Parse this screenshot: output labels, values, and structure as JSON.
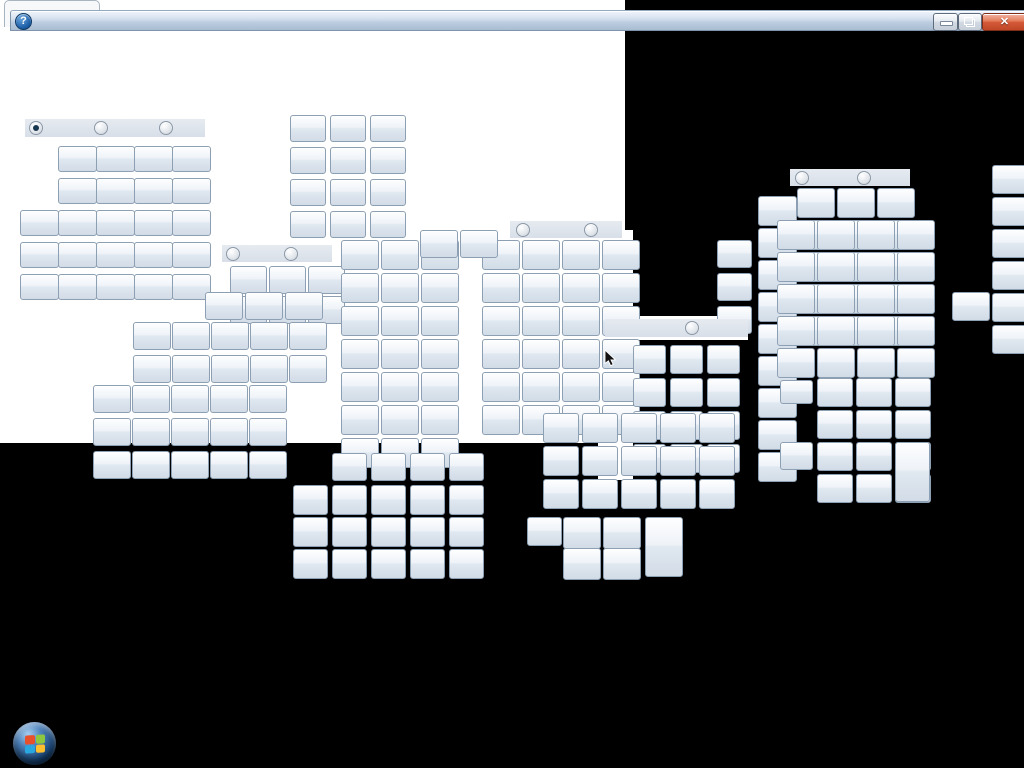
{
  "scene": {
    "desktop_bg": "#000000",
    "patch_color": "#ffffff",
    "white_patches": [
      {
        "x": 0,
        "y": 0,
        "w": 625,
        "h": 443
      },
      {
        "x": 598,
        "y": 230,
        "w": 35,
        "h": 250
      },
      {
        "x": 625,
        "y": 316,
        "w": 123,
        "h": 24
      }
    ]
  },
  "window": {
    "tab": {
      "x": 4,
      "y": 0,
      "w": 94,
      "h": 26
    },
    "titlebar": {
      "x": 10,
      "y": 10,
      "w": 1014,
      "h": 19
    },
    "help_icon_glyph": "?",
    "caption_buttons": [
      {
        "name": "minimize-button",
        "x": 922,
        "y": 2,
        "w": 23,
        "h": 16,
        "kind": "minimize"
      },
      {
        "name": "restore-button",
        "x": 947,
        "y": 2,
        "w": 22,
        "h": 16,
        "kind": "restore"
      },
      {
        "name": "close-button",
        "x": 971,
        "y": 2,
        "w": 43,
        "h": 16,
        "kind": "close",
        "glyph_char": "✕"
      }
    ]
  },
  "button_grids": [
    {
      "x": 58,
      "y": 146,
      "c": 4,
      "r": 2,
      "w": 37,
      "h": 24,
      "px": 38,
      "py": 32
    },
    {
      "x": 20,
      "y": 210,
      "c": 5,
      "r": 3,
      "w": 37,
      "h": 24,
      "px": 38,
      "py": 32
    },
    {
      "x": 290,
      "y": 115,
      "c": 3,
      "r": 4,
      "w": 34,
      "h": 25,
      "px": 40,
      "py": 32
    },
    {
      "x": 230,
      "y": 266,
      "c": 3,
      "r": 2,
      "w": 35,
      "h": 26,
      "px": 39,
      "py": 30
    },
    {
      "x": 205,
      "y": 292,
      "c": 3,
      "r": 1,
      "w": 36,
      "h": 26,
      "px": 40,
      "py": 33
    },
    {
      "x": 133,
      "y": 322,
      "c": 5,
      "r": 2,
      "w": 36,
      "h": 26,
      "px": 39,
      "py": 33
    },
    {
      "x": 93,
      "y": 385,
      "c": 5,
      "r": 3,
      "w": 36,
      "h": 26,
      "px": 39,
      "py": 33
    },
    {
      "x": 341,
      "y": 240,
      "c": 3,
      "r": 7,
      "w": 36,
      "h": 28,
      "px": 40,
      "py": 33
    },
    {
      "x": 482,
      "y": 240,
      "c": 4,
      "r": 6,
      "w": 36,
      "h": 28,
      "px": 40,
      "py": 33
    },
    {
      "x": 420,
      "y": 230,
      "c": 2,
      "r": 1,
      "w": 36,
      "h": 26,
      "px": 40,
      "py": 33
    },
    {
      "x": 717,
      "y": 240,
      "c": 1,
      "r": 3,
      "w": 33,
      "h": 26,
      "px": 40,
      "py": 33
    },
    {
      "x": 633,
      "y": 345,
      "c": 3,
      "r": 4,
      "w": 31,
      "h": 27,
      "px": 37,
      "py": 33
    },
    {
      "x": 758,
      "y": 196,
      "c": 1,
      "r": 9,
      "w": 37,
      "h": 28,
      "px": 40,
      "py": 32
    },
    {
      "x": 797,
      "y": 188,
      "c": 3,
      "r": 5,
      "w": 36,
      "h": 28,
      "px": 40,
      "py": 32
    },
    {
      "x": 777,
      "y": 220,
      "c": 4,
      "r": 5,
      "w": 36,
      "h": 28,
      "px": 40,
      "py": 32
    },
    {
      "x": 817,
      "y": 378,
      "c": 3,
      "r": 4,
      "w": 34,
      "h": 27,
      "px": 39,
      "py": 32
    },
    {
      "x": 992,
      "y": 165,
      "c": 1,
      "r": 6,
      "w": 32,
      "h": 27,
      "px": 40,
      "py": 32
    },
    {
      "x": 293,
      "y": 485,
      "c": 5,
      "r": 3,
      "w": 33,
      "h": 28,
      "px": 39,
      "py": 32
    },
    {
      "x": 332,
      "y": 453,
      "c": 4,
      "r": 1,
      "w": 33,
      "h": 26,
      "px": 39,
      "py": 32
    },
    {
      "x": 543,
      "y": 413,
      "c": 5,
      "r": 3,
      "w": 34,
      "h": 28,
      "px": 39,
      "py": 33
    },
    {
      "x": 563,
      "y": 517,
      "c": 2,
      "r": 2,
      "w": 36,
      "h": 30,
      "px": 40,
      "py": 31
    }
  ],
  "single_buttons": [
    {
      "x": 895,
      "y": 442,
      "w": 33,
      "h": 58
    },
    {
      "x": 645,
      "y": 517,
      "w": 36,
      "h": 58
    },
    {
      "x": 527,
      "y": 517,
      "w": 33,
      "h": 27
    },
    {
      "x": 780,
      "y": 380,
      "w": 31,
      "h": 22
    },
    {
      "x": 780,
      "y": 442,
      "w": 31,
      "h": 26
    },
    {
      "x": 952,
      "y": 292,
      "w": 36,
      "h": 27
    }
  ],
  "radio_bars": [
    {
      "x": 25,
      "y": 119,
      "w": 180,
      "h": 18,
      "radios": [
        {
          "dx": 4,
          "sel": true
        },
        {
          "dx": 69,
          "sel": false
        },
        {
          "dx": 134,
          "sel": false
        }
      ]
    },
    {
      "x": 222,
      "y": 245,
      "w": 110,
      "h": 17,
      "radios": [
        {
          "dx": 4,
          "sel": false
        },
        {
          "dx": 62,
          "sel": false
        }
      ]
    },
    {
      "x": 510,
      "y": 221,
      "w": 112,
      "h": 17,
      "radios": [
        {
          "dx": 6,
          "sel": false
        },
        {
          "dx": 74,
          "sel": false
        }
      ]
    },
    {
      "x": 790,
      "y": 169,
      "w": 120,
      "h": 17,
      "radios": [
        {
          "dx": 5,
          "sel": false
        },
        {
          "dx": 67,
          "sel": false
        }
      ]
    },
    {
      "x": 605,
      "y": 319,
      "w": 143,
      "h": 18,
      "radios": [
        {
          "dx": 80,
          "sel": false
        }
      ]
    }
  ],
  "cursor": {
    "x": 604,
    "y": 350
  },
  "taskbar": {
    "start_orb": {
      "x": 13,
      "y": 722,
      "size": 43
    },
    "flag_colors": [
      "#e8502c",
      "#8dc63f",
      "#29a8e0",
      "#fdbf2d"
    ]
  },
  "colors": {
    "button_border": "#8da0b3",
    "button_face_top": "#fdfeff",
    "button_face_bottom": "#d2dce7",
    "titlebar_top": "#f0f5fb",
    "titlebar_bottom": "#a9bcd2",
    "close_button_red": "#d45a38",
    "radio_bar": "#dde4ec",
    "radio_selected_dot": "#17374f",
    "help_icon_blue": "#1d5fa8"
  }
}
